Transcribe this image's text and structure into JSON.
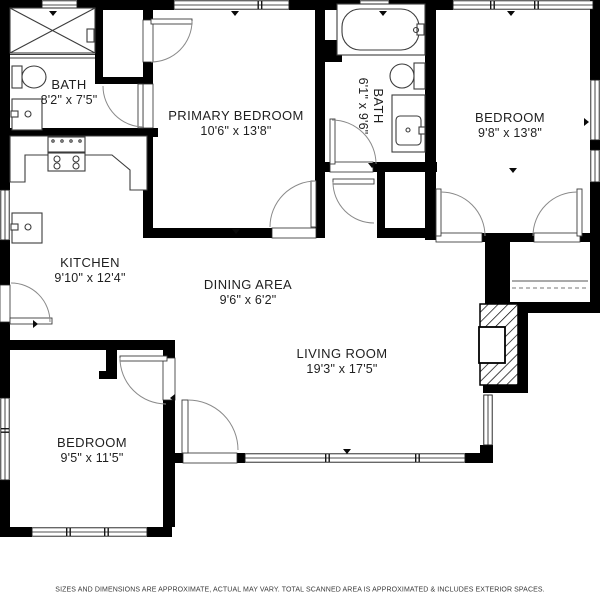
{
  "rooms": [
    {
      "name": "BATH",
      "dims": "8'2\" x 7'5\""
    },
    {
      "name": "PRIMARY BEDROOM",
      "dims": "10'6\" x 13'8\""
    },
    {
      "name": "BATH",
      "dims": "6'1\" x 9'6\""
    },
    {
      "name": "BEDROOM",
      "dims": "9'8\" x 13'8\""
    },
    {
      "name": "KITCHEN",
      "dims": "9'10\" x 12'4\""
    },
    {
      "name": "DINING AREA",
      "dims": "9'6\" x 6'2\""
    },
    {
      "name": "LIVING ROOM",
      "dims": "19'3\" x 17'5\""
    },
    {
      "name": "BEDROOM",
      "dims": "9'5\" x 11'5\""
    }
  ],
  "footer": {
    "disclaimer": "SIZES AND DIMENSIONS ARE APPROXIMATE, ACTUAL MAY VARY. TOTAL SCANNED AREA IS APPROXIMATED & INCLUDES EXTERIOR SPACES."
  },
  "colors": {
    "wall": "#000000",
    "fixture_line": "#3c3c3c",
    "door_arc": "#8a8a8a",
    "text": "#1f1f1f",
    "footer_text": "#3a3a3a"
  }
}
